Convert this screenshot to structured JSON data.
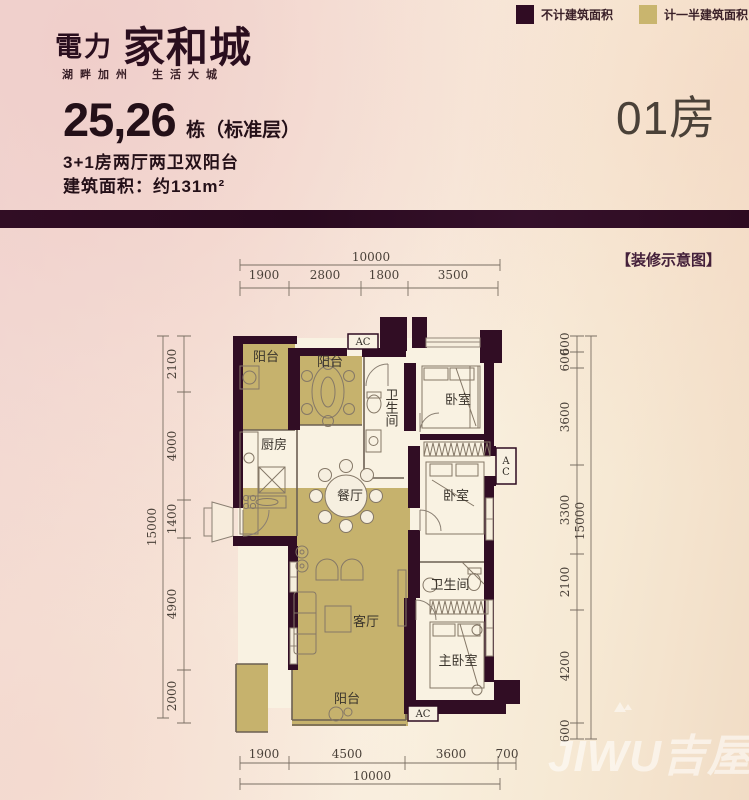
{
  "logo": {
    "prefix": "電力",
    "name": "家和城",
    "tagline": "湖畔加州　生活大城"
  },
  "legend": {
    "items": [
      {
        "label": "不计建筑面积",
        "color": "#300c23"
      },
      {
        "label": "计一半建筑面积",
        "color": "#c9b56e"
      }
    ]
  },
  "unit": {
    "block_numbers": "25,26",
    "block_suffix": "栋（标准层）",
    "layout_line": "3+1房两厅两卫双阳台",
    "area_line": "建筑面积：约131m²"
  },
  "room_tag": "01房",
  "note_tag": "【装修示意图】",
  "watermark": "JIWU吉屋",
  "colors": {
    "wall": "#310d24",
    "half_area": "#c6b26d",
    "band": "#2e0b21",
    "floor": "#f9f2e2"
  },
  "plan": {
    "ac_label": "AC",
    "rooms": [
      {
        "id": "balcony-nw",
        "label": "阳台"
      },
      {
        "id": "balcony-n",
        "label": "阳台"
      },
      {
        "id": "bathroom-1",
        "label": "卫生间"
      },
      {
        "id": "bedroom-1",
        "label": "卧室"
      },
      {
        "id": "kitchen",
        "label": "厨房"
      },
      {
        "id": "dining-room",
        "label": "餐厅"
      },
      {
        "id": "bedroom-2",
        "label": "卧室"
      },
      {
        "id": "bathroom-2",
        "label": "卫生间"
      },
      {
        "id": "living-room",
        "label": "客厅"
      },
      {
        "id": "master-bedroom",
        "label": "主卧室"
      },
      {
        "id": "balcony-s",
        "label": "阳台"
      }
    ],
    "dims": {
      "top": {
        "total": "10000",
        "segments": [
          "1900",
          "2800",
          "1800",
          "3500"
        ]
      },
      "bottom": {
        "total": "10000",
        "segments": [
          "1900",
          "4500",
          "3600",
          "700"
        ]
      },
      "left": {
        "total": "15000",
        "segments": [
          "2100",
          "4000",
          "1400",
          "4900",
          "2000"
        ]
      },
      "right": {
        "total": "15000",
        "segments": [
          "600",
          "600",
          "3600",
          "3300",
          "2100",
          "4200",
          "600"
        ]
      }
    }
  }
}
